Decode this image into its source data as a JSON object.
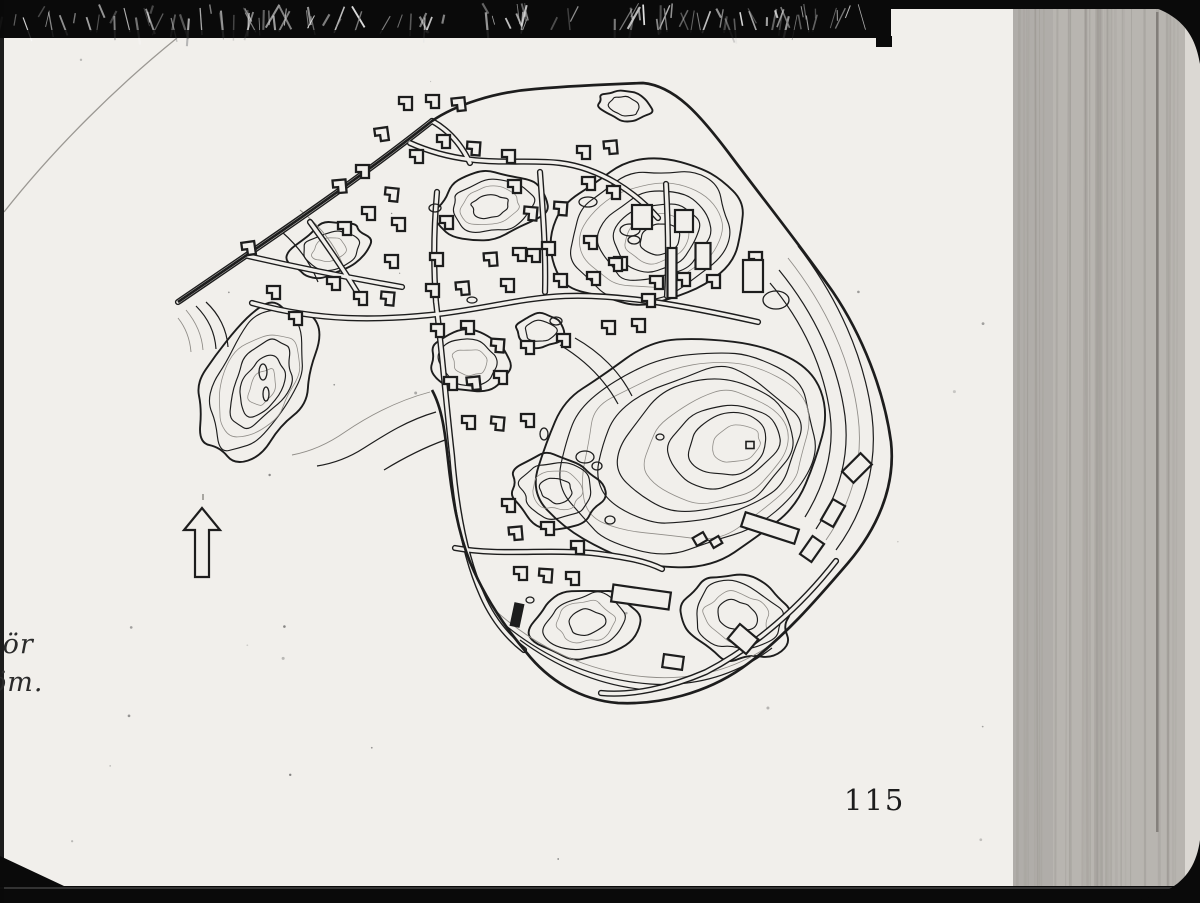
{
  "page": {
    "number": "115",
    "caption_fragments": [
      "iör",
      "öm."
    ]
  },
  "colors": {
    "page": "#f1efeb",
    "ink": "#1d1d1d",
    "faint": "#908d88",
    "frame_black": "#0a0a0a",
    "right_strip": "#b8b5b0",
    "right_edge": "#dbd8d3",
    "streak": "#6f6b66",
    "arc_scratch": "#9b9893"
  },
  "map": {
    "boundary": "M178,302 C260,246 350,186 432,121 C455,105 495,92 535,89 C570,86 615,84 643,83 C675,86 700,115 728,152 C760,195 800,245 833,292 C862,335 884,390 891,442 C896,488 876,530 848,563 C818,598 782,640 742,668 C706,693 660,705 618,703 C580,700 548,680 526,652 C505,627 484,596 470,562 C458,532 452,497 448,460 C445,432 442,408 432,390",
    "roads": [
      "M178,302 C260,246 350,186 432,121",
      "M410,143 C470,170 520,158 560,163 C600,168 635,192 658,218",
      "M252,303 C320,322 380,320 430,315 C480,310 520,298 565,296 C620,294 682,305 758,322",
      "M437,192 C434,226 433,262 436,302",
      "M540,172 C543,212 546,252 545,292",
      "M248,256 C300,268 350,278 402,287",
      "M310,222 C332,252 350,280 362,300",
      "M436,302 C442,352 446,402 452,455 C456,505 464,555 482,595 C492,618 506,636 524,650",
      "M455,548 C500,556 545,549 592,553 C625,557 646,561 662,569",
      "M666,184 C668,222 669,258 667,296",
      "M836,561 C801,606 756,646 706,672 C669,688 631,696 601,693",
      "M432,121 C450,131 462,146 470,163"
    ],
    "contour_bands": [
      "M798,246 C838,298 864,356 872,416 C878,466 864,512 836,550",
      "M788,258 C826,306 851,360 858,416 C864,462 851,504 826,540",
      "M779,270 C815,314 838,364 845,416 C850,458 838,496 816,529",
      "M770,283 C803,322 824,368 830,414 C835,452 824,486 805,517",
      "M497,612 C540,650 592,673 648,677 C700,681 744,666 780,638",
      "M505,625 C548,660 596,680 650,684 C698,687 738,674 772,648",
      "M520,640 C558,668 600,686 648,690",
      "M430,392 C400,400 370,415 345,432 C325,446 308,452 292,455",
      "M436,412 C408,420 386,434 364,448 C347,459 330,464 317,466",
      "M445,440 C423,448 402,459 384,470",
      "M186,310 C196,322 202,336 203,350",
      "M196,306 C208,318 215,333 216,349",
      "M206,302 C219,314 227,330 228,347",
      "M178,318 C186,328 190,340 191,352",
      "M560,345 C585,360 605,380 618,404",
      "M575,338 C600,352 620,372 632,396",
      "M300,210 C320,226 336,246 344,268",
      "M282,232 C298,246 310,262 318,282"
    ],
    "hills": [
      {
        "cx": 648,
        "cy": 233,
        "rx": 95,
        "ry": 72,
        "rot": -18,
        "levels": 7,
        "dx": 2,
        "dy": 1,
        "seed": 11
      },
      {
        "cx": 680,
        "cy": 452,
        "rx": 150,
        "ry": 112,
        "rot": -15,
        "levels": 9,
        "dx": 7,
        "dy": -1,
        "seed": 23
      },
      {
        "cx": 257,
        "cy": 378,
        "rx": 50,
        "ry": 84,
        "rot": 28,
        "levels": 6,
        "dx": 1,
        "dy": 2,
        "seed": 37
      },
      {
        "cx": 330,
        "cy": 250,
        "rx": 40,
        "ry": 26,
        "rot": -15,
        "levels": 3,
        "dx": 0,
        "dy": 0,
        "seed": 41
      },
      {
        "cx": 490,
        "cy": 206,
        "rx": 54,
        "ry": 33,
        "rot": -8,
        "levels": 4,
        "dx": 0,
        "dy": 0,
        "seed": 53
      },
      {
        "cx": 470,
        "cy": 362,
        "rx": 42,
        "ry": 30,
        "rot": 6,
        "levels": 3,
        "dx": 0,
        "dy": 0,
        "seed": 61
      },
      {
        "cx": 556,
        "cy": 490,
        "rx": 46,
        "ry": 36,
        "rot": 10,
        "levels": 4,
        "dx": 0,
        "dy": 0,
        "seed": 71
      },
      {
        "cx": 586,
        "cy": 622,
        "rx": 52,
        "ry": 36,
        "rot": -8,
        "levels": 4,
        "dx": 0,
        "dy": 0,
        "seed": 83
      },
      {
        "cx": 737,
        "cy": 616,
        "rx": 56,
        "ry": 44,
        "rot": 12,
        "levels": 4,
        "dx": 0,
        "dy": 0,
        "seed": 97
      },
      {
        "cx": 625,
        "cy": 106,
        "rx": 26,
        "ry": 15,
        "rot": 12,
        "levels": 2,
        "dx": 0,
        "dy": 0,
        "seed": 101
      },
      {
        "cx": 540,
        "cy": 331,
        "rx": 25,
        "ry": 17,
        "rot": 0,
        "levels": 2,
        "dx": 0,
        "dy": 0,
        "seed": 103
      }
    ],
    "ponds": [
      [
        588,
        202,
        9,
        5
      ],
      [
        472,
        300,
        5,
        3
      ],
      [
        556,
        321,
        6,
        4
      ],
      [
        263,
        372,
        4,
        8
      ],
      [
        266,
        394,
        3,
        7
      ],
      [
        585,
        457,
        9,
        6
      ],
      [
        597,
        466,
        5,
        4
      ],
      [
        660,
        437,
        4,
        3
      ],
      [
        435,
        208,
        6,
        4
      ],
      [
        544,
        434,
        4,
        6
      ],
      [
        610,
        520,
        5,
        4
      ],
      [
        776,
        300,
        13,
        9
      ],
      [
        530,
        600,
        4,
        3
      ],
      [
        634,
        240,
        6,
        4
      ],
      [
        630,
        230,
        10,
        6
      ]
    ],
    "summit_mark": [
      750,
      445,
      8,
      7
    ],
    "houses": [
      [
        405,
        103,
        0
      ],
      [
        432,
        101,
        0
      ],
      [
        458,
        104,
        -6
      ],
      [
        381,
        134,
        -8
      ],
      [
        443,
        141,
        0
      ],
      [
        473,
        148,
        4
      ],
      [
        508,
        156,
        0
      ],
      [
        416,
        156,
        0
      ],
      [
        362,
        171,
        0
      ],
      [
        339,
        186,
        -5
      ],
      [
        391,
        194,
        6
      ],
      [
        514,
        186,
        0
      ],
      [
        368,
        213,
        0
      ],
      [
        344,
        228,
        0
      ],
      [
        398,
        224,
        0
      ],
      [
        446,
        222,
        0
      ],
      [
        530,
        213,
        5
      ],
      [
        533,
        255,
        0
      ],
      [
        391,
        261,
        0
      ],
      [
        436,
        259,
        0
      ],
      [
        490,
        259,
        -4
      ],
      [
        519,
        254,
        0
      ],
      [
        548,
        248,
        0
      ],
      [
        248,
        248,
        -8
      ],
      [
        273,
        292,
        0
      ],
      [
        295,
        318,
        0
      ],
      [
        333,
        283,
        0
      ],
      [
        360,
        298,
        0
      ],
      [
        387,
        298,
        5
      ],
      [
        432,
        290,
        0
      ],
      [
        437,
        330,
        0
      ],
      [
        507,
        285,
        0
      ],
      [
        462,
        288,
        -5
      ],
      [
        560,
        280,
        0
      ],
      [
        593,
        278,
        0
      ],
      [
        467,
        327,
        0
      ],
      [
        497,
        345,
        4
      ],
      [
        527,
        347,
        0
      ],
      [
        563,
        340,
        0
      ],
      [
        450,
        383,
        0
      ],
      [
        473,
        383,
        -6
      ],
      [
        500,
        377,
        0
      ],
      [
        468,
        422,
        0
      ],
      [
        497,
        423,
        5
      ],
      [
        527,
        420,
        0
      ],
      [
        608,
        327,
        0
      ],
      [
        638,
        325,
        0
      ],
      [
        583,
        152,
        0
      ],
      [
        610,
        147,
        -5
      ],
      [
        588,
        183,
        0
      ],
      [
        613,
        192,
        0
      ],
      [
        560,
        208,
        4
      ],
      [
        590,
        242,
        0
      ],
      [
        620,
        263,
        0
      ],
      [
        648,
        300,
        0
      ],
      [
        755,
        258,
        0
      ],
      [
        508,
        505,
        0
      ],
      [
        515,
        533,
        -5
      ],
      [
        547,
        528,
        0
      ],
      [
        577,
        547,
        0
      ],
      [
        520,
        573,
        0
      ],
      [
        545,
        575,
        4
      ],
      [
        572,
        578,
        0
      ],
      [
        615,
        264,
        0
      ],
      [
        656,
        282,
        0
      ],
      [
        683,
        279,
        0
      ],
      [
        713,
        281,
        0
      ]
    ],
    "buildings": [
      [
        642,
        217,
        20,
        24,
        0,
        0
      ],
      [
        684,
        221,
        18,
        22,
        0,
        0
      ],
      [
        703,
        256,
        15,
        26,
        0,
        0
      ],
      [
        753,
        276,
        20,
        32,
        0,
        0
      ],
      [
        672,
        273,
        9,
        50,
        0,
        0
      ],
      [
        857,
        468,
        16,
        26,
        45,
        0
      ],
      [
        833,
        513,
        14,
        24,
        30,
        0
      ],
      [
        812,
        549,
        14,
        22,
        35,
        0
      ],
      [
        770,
        528,
        56,
        15,
        18,
        0
      ],
      [
        641,
        597,
        58,
        17,
        8,
        0
      ],
      [
        673,
        662,
        20,
        13,
        8,
        0
      ],
      [
        743,
        639,
        24,
        19,
        40,
        0
      ],
      [
        517,
        615,
        8,
        22,
        12,
        1
      ],
      [
        700,
        539,
        12,
        9,
        -30,
        0
      ],
      [
        716,
        542,
        10,
        8,
        -30,
        0
      ]
    ],
    "north_arrow": {
      "cx": 202,
      "top": 508
    }
  }
}
